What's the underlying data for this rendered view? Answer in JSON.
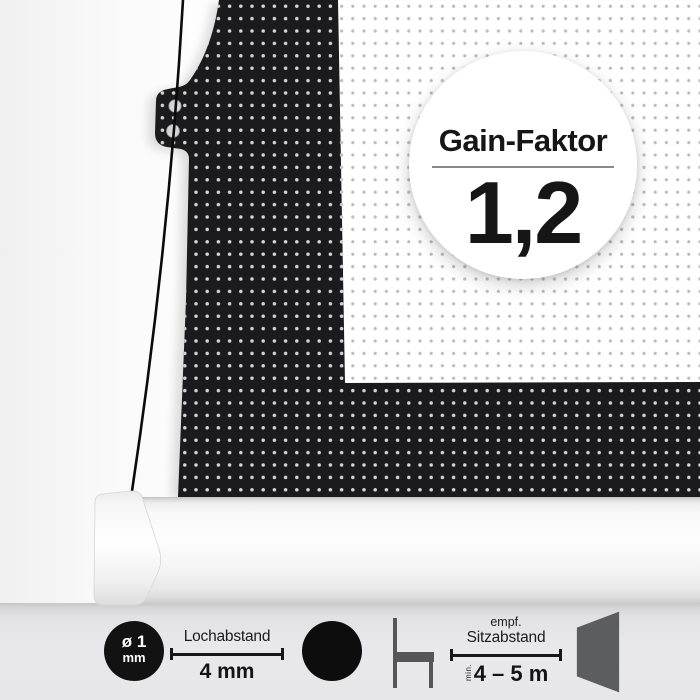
{
  "badge": {
    "title": "Gain-Faktor",
    "value": "1,2"
  },
  "hole_spec": {
    "diameter": "ø 1",
    "unit": "mm"
  },
  "pitch_spec": {
    "label": "Lochabstand",
    "value": "4 mm"
  },
  "seating_spec": {
    "qualifier": "empf.",
    "label": "Sitzabstand",
    "min": "min.",
    "value": "4 – 5 m"
  },
  "icons": {
    "hole_size_icon": "black-circle-with-diameter-text",
    "dot_icon": "solid-black-circle",
    "chair_icon": "chair-side-view",
    "screen_icon": "screen-side-trapezoid",
    "grommet_icons": "two-eyelet-holes-on-fabric-tab"
  },
  "colors": {
    "fabric_black": "#1b1b1d",
    "fabric_dot": "#d6d6d6",
    "surface_white": "#ffffff",
    "surface_dot": "#bcbcbe",
    "floor_gray": "#e7e7e9",
    "icon_gray": "#55565a",
    "icon_black": "#121212",
    "text_dark": "#1a1a1a"
  }
}
